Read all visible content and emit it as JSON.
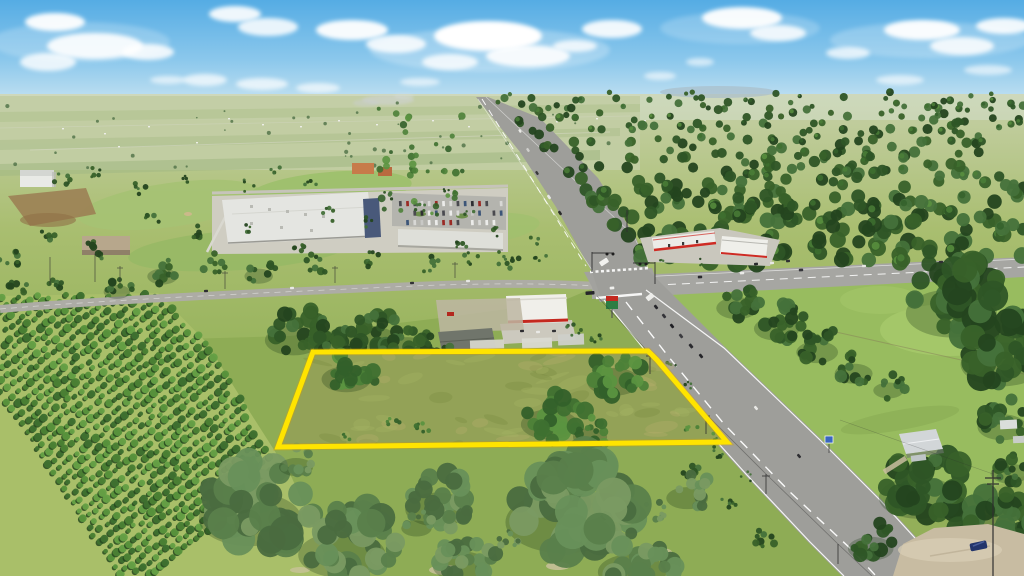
{
  "photo": {
    "title": "Aerial land-listing photo",
    "description": "Aerial drone photo of a vacant grass parcel outlined in yellow beside a two-lane highway that runs to the horizon, a signalized cross-street intersection with a gas station and convenience store, a white-roofed shopping plaza with parking lot, diagonal rows of farmed trees on the left, dense forest on the right, lawns with a small house, a sandy driveway with a dark blue car, and a blue sky with puffy white clouds and a faint smoke plume on the horizon",
    "width_px": 1024,
    "height_px": 576
  },
  "overlay": {
    "parcel_outline": {
      "shape": "quadrilateral",
      "color": "#FFE400",
      "stroke_width_px": 5,
      "corners_px": [
        [
          313,
          352
        ],
        [
          657,
          360
        ],
        [
          727,
          442
        ],
        [
          278,
          447
        ]
      ]
    }
  },
  "palette": {
    "sky_top": "#5FB2E6",
    "sky_horizon": "#C9E4F1",
    "cloud": "#FFFFFF",
    "far_field": "#C2CDA4",
    "grass_mid": "#97B35C",
    "lawn_bright": "#98BC5F",
    "parcel_grass": "#93A257",
    "orchard_grass": "#A9BF69",
    "forest_dark": "#2E5526",
    "scrub_green": "#5A7F4B",
    "road_asphalt": "#9E9E9A",
    "road_marking": "#FFFFFF",
    "plaza_roof": "#E4E5E1",
    "gas_red": "#CE2B24",
    "dirt_tan": "#C8BCA2",
    "outline_yellow": "#FFE400",
    "parked_car_blue": "#23356B"
  },
  "landmarks": [
    {
      "name": "outlined-parcel",
      "label": "vacant parcel with yellow boundary overlay"
    },
    {
      "name": "highway",
      "label": "two-lane highway running to the horizon"
    },
    {
      "name": "cross-street",
      "label": "cross street at signalized intersection"
    },
    {
      "name": "shopping-plaza",
      "label": "white-roofed retail plaza with parking lot"
    },
    {
      "name": "gas-station",
      "label": "gas station with red-striped canopy"
    },
    {
      "name": "convenience-store",
      "label": "convenience store with red awning and price sign"
    },
    {
      "name": "tree-farm",
      "label": "diagonal rows of planted trees"
    },
    {
      "name": "forest",
      "label": "dense woodland"
    },
    {
      "name": "golf-course",
      "label": "golf fairways with scattered trees"
    },
    {
      "name": "house-with-lawn",
      "label": "small house on a large lawn"
    },
    {
      "name": "dirt-driveway",
      "label": "sandy driveway with parked car"
    },
    {
      "name": "sky",
      "label": "blue sky with cumulus clouds"
    },
    {
      "name": "smoke-plume",
      "label": "distant smoke plume on the horizon"
    }
  ]
}
